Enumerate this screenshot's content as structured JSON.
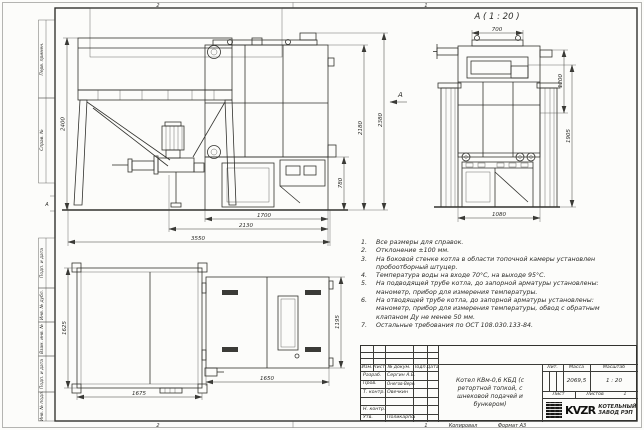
{
  "frame": {
    "zones_top": [
      "2",
      "1"
    ],
    "zones_bottom": [
      "2",
      "1"
    ],
    "zone_row_marker": "А",
    "copied": "Копировал",
    "format": "Формат А3",
    "margin_labels": [
      "Перв. примен.",
      "Справ. №",
      "Подп. и дата",
      "Инв. № дубл.",
      "Взам. инв. №",
      "Подп. и дата",
      "Инв. № подл."
    ]
  },
  "views": {
    "detail_label": "А ( 1 : 20 )",
    "arrow_label": "А"
  },
  "dims": {
    "front": {
      "h_bunker": "2400",
      "h_boiler_1": "2180",
      "h_boiler_2": "2380",
      "h_ash": "780",
      "w_furnace": "1700",
      "w_boiler": "2130",
      "w_total": "3550"
    },
    "side": {
      "w_top": "700",
      "h_upper": "1200",
      "h_body": "1905",
      "w_bottom": "1080"
    },
    "plan": {
      "bunker_depth": "1625",
      "bunker_width": "1675",
      "boiler_width": "1650",
      "boiler_depth": "1195"
    }
  },
  "notes": {
    "items": [
      {
        "n": "1.",
        "text": "Все размеры для справок."
      },
      {
        "n": "2.",
        "text": "Отклонение ±100 мм."
      },
      {
        "n": "3.",
        "text": "На боковой стенке котла в области топочной камеры установлен пробоотборный штуцер."
      },
      {
        "n": "4.",
        "text": "Температура воды на входе 70°С, на выходе 95°С."
      },
      {
        "n": "5.",
        "text": "На подводящей трубе котла, до запорной арматуры установлены: манометр, прибор для измерения температуры."
      },
      {
        "n": "6.",
        "text": "На отводящей трубе котла, до запорной арматуры установлены: манометр, прибор для измерения температуры, обвод с обратным клапаном Ду не менее 50 мм."
      },
      {
        "n": "7.",
        "text": "Остальные требования по ОСТ 108.030.133-84."
      }
    ]
  },
  "title_block": {
    "cols": {
      "izm": "Изм.",
      "list": "Лист",
      "doc": "№ докум.",
      "sign": "Подп.",
      "date": "Дата"
    },
    "rows": [
      {
        "role": "Разраб.",
        "name": "Сергин А.В."
      },
      {
        "role": "Пров.",
        "name": "Онегов-Вережинский"
      },
      {
        "role": "Т. контр.",
        "name": "Овечкин"
      },
      {
        "role": "",
        "name": ""
      },
      {
        "role": "Н. контр.",
        "name": ""
      },
      {
        "role": "Утв.",
        "name": "Поликарпова"
      }
    ],
    "title": "Котел КВм-0,6 КБД (с ретортной топкой, с шнековой подачей и бункером)",
    "lit_label": "Лит.",
    "mass_label": "Масса",
    "scale_label": "Масштаб",
    "mass": "2069,5",
    "scale": "1 : 20",
    "sheet_label": "Лист",
    "sheets_label": "Листов",
    "sheets_value": "1",
    "logo": "KVZR",
    "company_line1": "КОТЕЛЬНЫЙ",
    "company_line2": "ЗАВОД РЭП"
  }
}
